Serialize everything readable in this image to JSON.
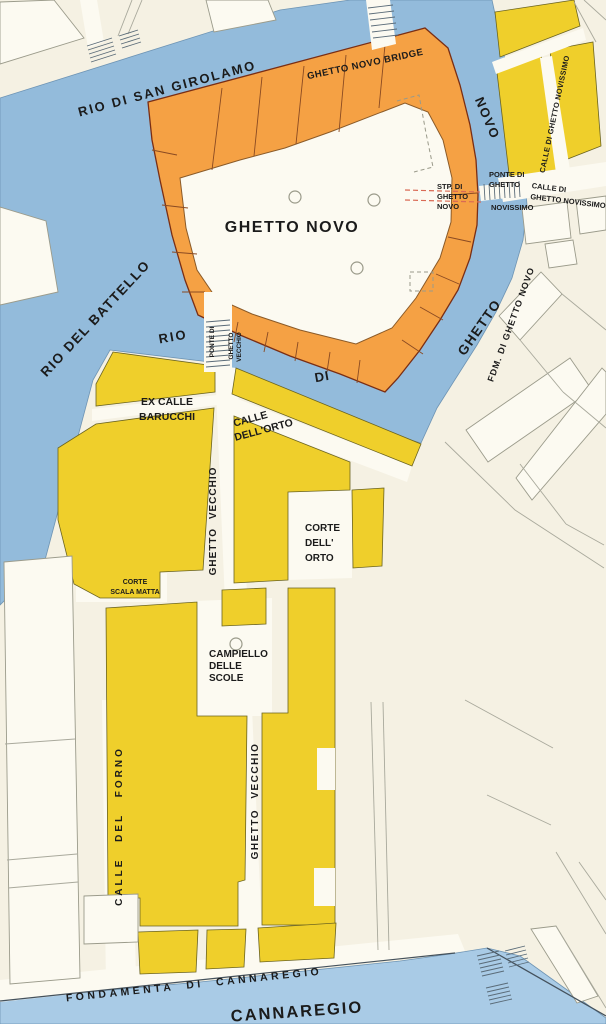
{
  "map": {
    "colors": {
      "background": "#F5F1E3",
      "water": "#93BBDB",
      "water_light": "#A9CBE6",
      "ghetto_novo_fill": "#F5A144",
      "ghetto_vecchio_fill": "#EFCF2B",
      "paper_white": "#FCFAF1",
      "label_ink": "#1b1b1b"
    },
    "labels": {
      "rio_san_girolamo": "RIO DI SAN GIROLAMO",
      "ghetto_novo_bridge": "GHETTO NOVO  BRIDGE",
      "ghetto_novo": "GHETTO NOVO",
      "canal_rio": "RIO",
      "canal_di": "DI",
      "canal_ghetto": "GHETTO",
      "canal_novo": "NOVO",
      "fdm_di_ghetto_novo": "FDM.  DI  GHETTO  NOVO",
      "stp_l1": "STP. DI",
      "stp_l2": "GHETTO",
      "stp_l3": "NOVO",
      "ponte_novissimo_l1": "PONTE DI",
      "ponte_novissimo_l2": "GHETTO",
      "ponte_novissimo_l3": "NOVISSIMO",
      "calle_novissimo_l1": "CALLE DI",
      "calle_novissimo_l2": "GHETTO NOVISSIMO",
      "calle_novissimo_vertical": "CALLE DI GHETTO NOVISSIMO",
      "rio_del_battello": "RIO DEL BATTELLO",
      "ponte_vecchio_l1": "PONTE DI",
      "ponte_vecchio_l2": "GHETTO",
      "ponte_vecchio_l3": "VECCHIO",
      "ex_calle_barucchi_l1": "EX  CALLE",
      "ex_calle_barucchi_l2": "BARUCCHI",
      "calle_dellorto_l1": "CALLE",
      "calle_dellorto_l2": "DELL'ORTO",
      "ghetto_vecchio_upper": "GHETTO VECCHIO",
      "ghetto_vecchio_lower": "GHETTO VECCHIO",
      "corte_scala_matta_l1": "CORTE",
      "corte_scala_matta_l2": "SCALA MATTA",
      "campiello_l1": "CAMPIELLO",
      "campiello_l2": "DELLE",
      "campiello_l3": "SCOLE",
      "corte_dellorto_l1": "CORTE",
      "corte_dellorto_l2": "DELL'",
      "corte_dellorto_l3": "ORTO",
      "calle_del_forno": "CALLE  DEL  FORNO",
      "fondamenta_di_cannaregio": "FONDAMENTA  DI  CANNAREGIO",
      "cannaregio": "CANNAREGIO"
    }
  }
}
